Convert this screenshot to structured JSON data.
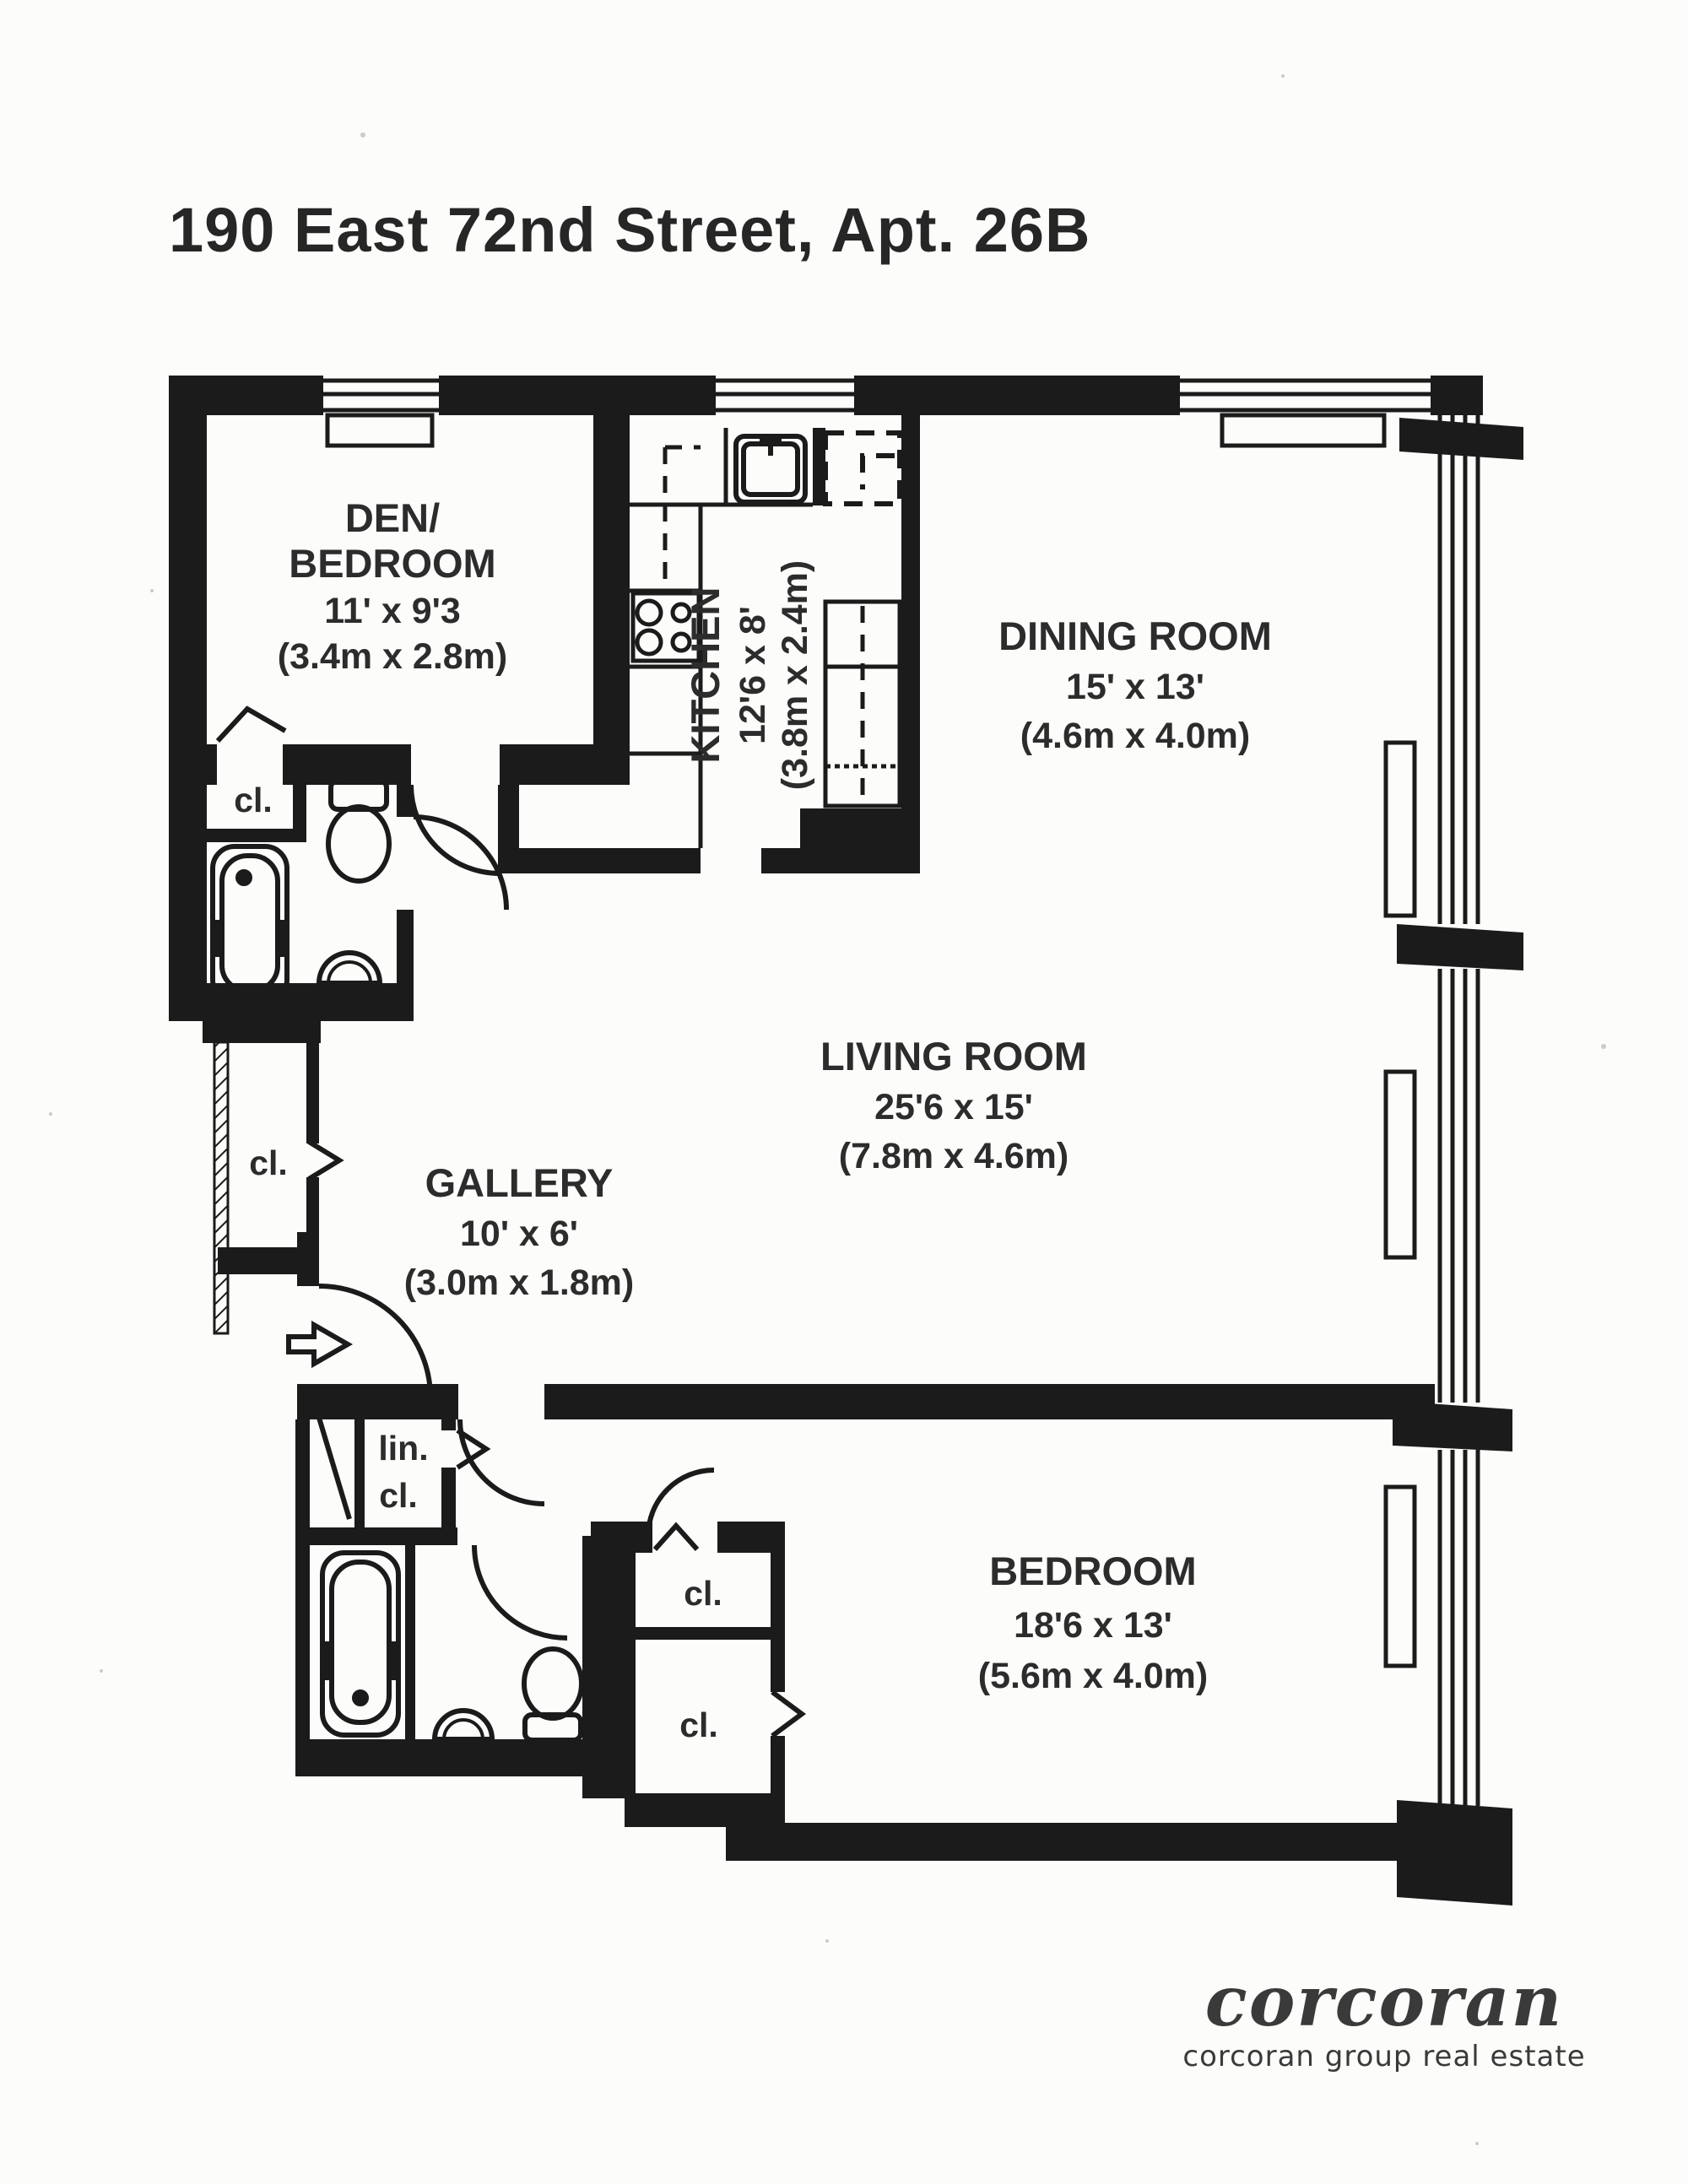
{
  "title": "190 East 72nd Street, Apt. 26B",
  "rooms": {
    "den": {
      "name1": "DEN/",
      "name2": "BEDROOM",
      "imperial": "11' x 9'3",
      "metric": "(3.4m x 2.8m)"
    },
    "kitchen": {
      "name": "KITCHEN",
      "imperial": "12'6 x 8'",
      "metric": "(3.8m x 2.4m)"
    },
    "dining": {
      "name": "DINING ROOM",
      "imperial": "15' x 13'",
      "metric": "(4.6m x 4.0m)"
    },
    "living": {
      "name": "LIVING ROOM",
      "imperial": "25'6 x 15'",
      "metric": "(7.8m x 4.6m)"
    },
    "gallery": {
      "name": "GALLERY",
      "imperial": "10' x 6'",
      "metric": "(3.0m x 1.8m)"
    },
    "bedroom": {
      "name": "BEDROOM",
      "imperial": "18'6 x 13'",
      "metric": "(5.6m x 4.0m)"
    }
  },
  "closets": {
    "bath1": "cl.",
    "gallery": "cl.",
    "bedroom_upper": "cl.",
    "bedroom_lower": "cl.",
    "linen1": "lin.",
    "linen2": "cl."
  },
  "logo": {
    "brand": "corcoran",
    "tagline": "corcoran group real estate"
  },
  "colors": {
    "ink": "#1b1b1b",
    "paper": "#fcfcfa"
  }
}
